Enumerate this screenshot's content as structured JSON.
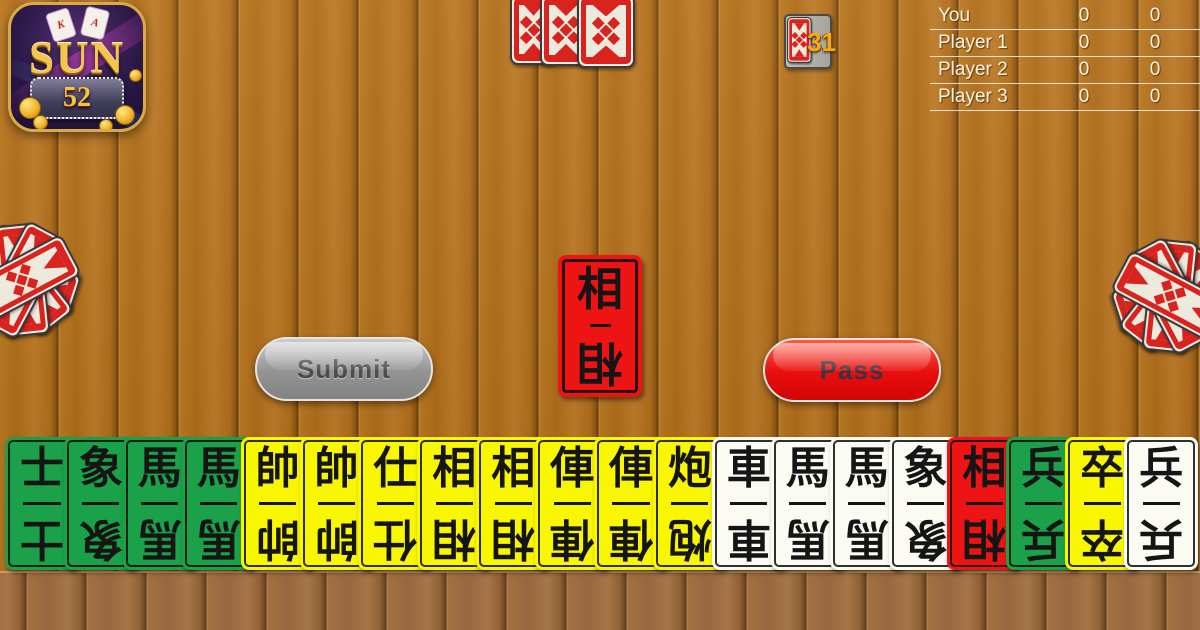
{
  "brand": {
    "name_top": "SUN",
    "name_number": "52",
    "card_letters": [
      "K",
      "A"
    ]
  },
  "scoreboard": {
    "rows": [
      {
        "name": "You",
        "score_a": "0",
        "score_b": "0"
      },
      {
        "name": "Player 1",
        "score_a": "0",
        "score_b": "0"
      },
      {
        "name": "Player 2",
        "score_a": "0",
        "score_b": "0"
      },
      {
        "name": "Player 3",
        "score_a": "0",
        "score_b": "0"
      }
    ]
  },
  "deck": {
    "remaining": "31"
  },
  "played_card": {
    "label": "相",
    "color": "red"
  },
  "opponents": {
    "top": {
      "count": 3
    },
    "left": {
      "count": 5
    },
    "right": {
      "count": 5
    }
  },
  "actions": {
    "submit": "Submit",
    "pass": "Pass"
  },
  "hand": {
    "cards": [
      {
        "label": "士",
        "color": "green"
      },
      {
        "label": "象",
        "color": "green"
      },
      {
        "label": "馬",
        "color": "green"
      },
      {
        "label": "馬",
        "color": "green"
      },
      {
        "label": "帥",
        "color": "yellow"
      },
      {
        "label": "帥",
        "color": "yellow"
      },
      {
        "label": "仕",
        "color": "yellow"
      },
      {
        "label": "相",
        "color": "yellow"
      },
      {
        "label": "相",
        "color": "yellow"
      },
      {
        "label": "俥",
        "color": "yellow"
      },
      {
        "label": "俥",
        "color": "yellow"
      },
      {
        "label": "炮",
        "color": "yellow"
      },
      {
        "label": "車",
        "color": "white"
      },
      {
        "label": "馬",
        "color": "white"
      },
      {
        "label": "馬",
        "color": "white"
      },
      {
        "label": "象",
        "color": "white"
      },
      {
        "label": "相",
        "color": "red"
      },
      {
        "label": "兵",
        "color": "green"
      },
      {
        "label": "卒",
        "color": "yellow"
      },
      {
        "label": "兵",
        "color": "white"
      }
    ]
  },
  "colors": {
    "wood": "#b2701e",
    "card_green": "#1ba14a",
    "card_yellow": "#f8f600",
    "card_white": "#fbfaf3",
    "card_red": "#ee1414",
    "card_back_red": "#d8231f",
    "button_submit": "#9a9a9a",
    "button_pass": "#e90e0e",
    "deck_count_gold": "#f7a81c",
    "score_text": "#fdf4e6"
  }
}
